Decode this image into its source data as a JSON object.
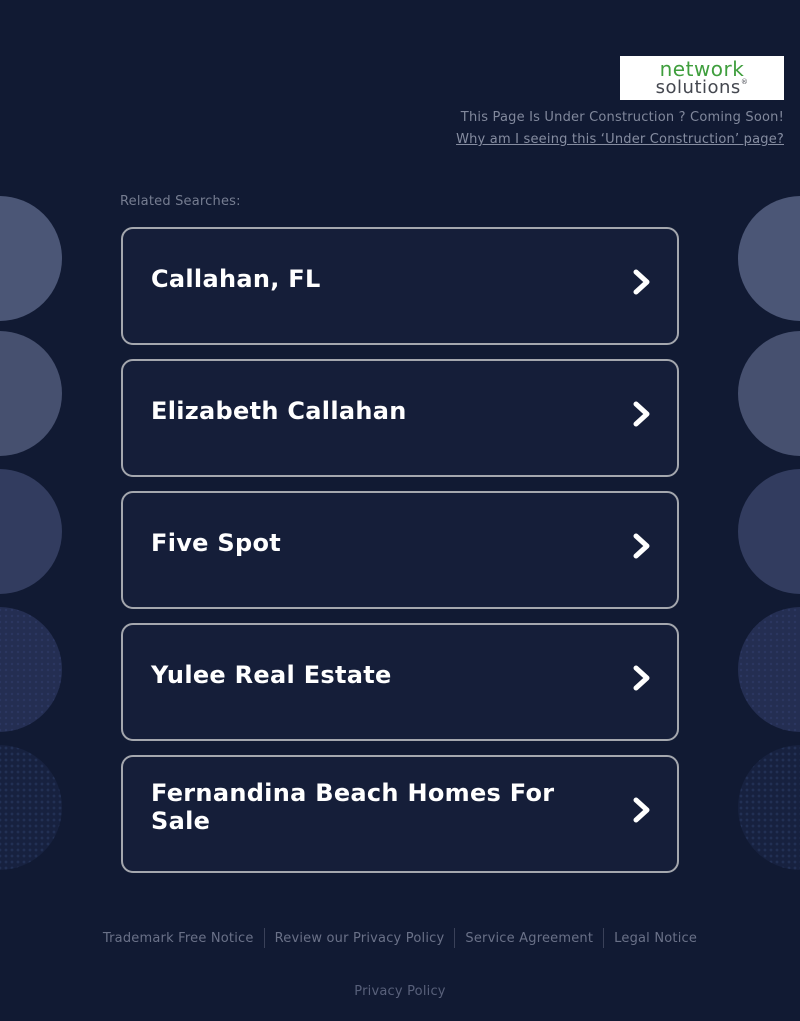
{
  "colors": {
    "page_background": "#111a33",
    "card_background": "#151e39",
    "card_border": "#a4a7ae",
    "card_title": "#ffffff",
    "logo_green": "#3f9e3d",
    "logo_gray": "#44474f",
    "muted_text": "#7d8498"
  },
  "logo": {
    "line1": "network",
    "line2": "solutions",
    "registered": "®"
  },
  "header": {
    "construction_text": "This Page Is Under Construction ? Coming Soon!",
    "why_link": "Why am I seeing this ‘Under Construction’ page?"
  },
  "related": {
    "label": "Related Searches:",
    "items": [
      {
        "label": "Callahan, FL"
      },
      {
        "label": "Elizabeth Callahan"
      },
      {
        "label": "Five Spot"
      },
      {
        "label": "Yulee Real Estate"
      },
      {
        "label": "Fernandina Beach Homes For Sale"
      }
    ]
  },
  "footer": {
    "links": [
      "Trademark Free Notice",
      "Review our Privacy Policy",
      "Service Agreement",
      "Legal Notice"
    ],
    "privacy": "Privacy Policy"
  }
}
